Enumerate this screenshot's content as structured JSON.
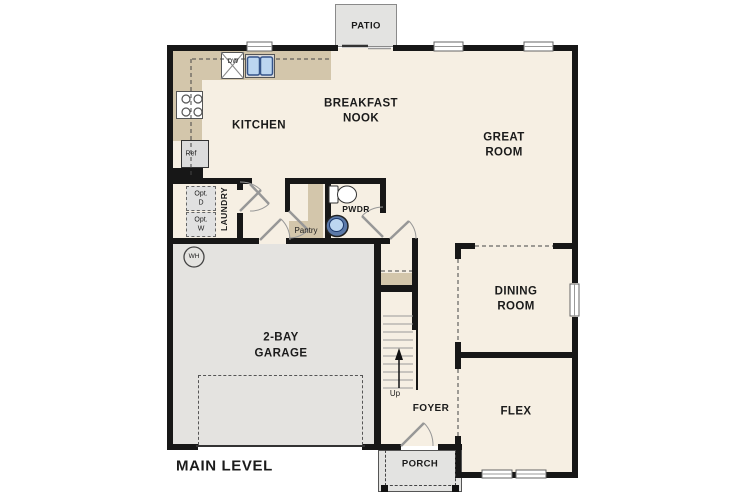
{
  "level": {
    "label": "MAIN LEVEL"
  },
  "rooms": {
    "kitchen": {
      "label": "KITCHEN"
    },
    "breakfast_nook": {
      "lines": [
        "BREAKFAST",
        "NOOK"
      ]
    },
    "great_room": {
      "lines": [
        "GREAT",
        "ROOM"
      ]
    },
    "dining_room": {
      "lines": [
        "DINING",
        "ROOM"
      ]
    },
    "flex": {
      "label": "FLEX"
    },
    "garage": {
      "lines": [
        "2-BAY",
        "GARAGE"
      ]
    },
    "foyer": {
      "label": "FOYER"
    },
    "porch": {
      "label": "PORCH"
    },
    "patio": {
      "label": "PATIO"
    },
    "laundry": {
      "label": "LAUNDRY"
    },
    "pantry": {
      "label": "Pantry"
    },
    "powder_room": {
      "label": "PWDR"
    }
  },
  "fixtures": {
    "dishwasher": {
      "label": "DW"
    },
    "refrigerator": {
      "label": "Ref"
    },
    "water_heater": {
      "label": "WH"
    },
    "optional_dryer": {
      "lines": [
        "Opt.",
        "D"
      ]
    },
    "optional_washer": {
      "lines": [
        "Opt.",
        "W"
      ]
    },
    "stairs": {
      "direction_label": "Up"
    }
  },
  "colors": {
    "floor": "#f6efe3",
    "counter_tan": "#d3c6ab",
    "garage_floor": "#e4e3e0",
    "exterior_concrete": "#e3e3e1",
    "wall": "#171717",
    "sink_blue": "#bcd6f0"
  }
}
